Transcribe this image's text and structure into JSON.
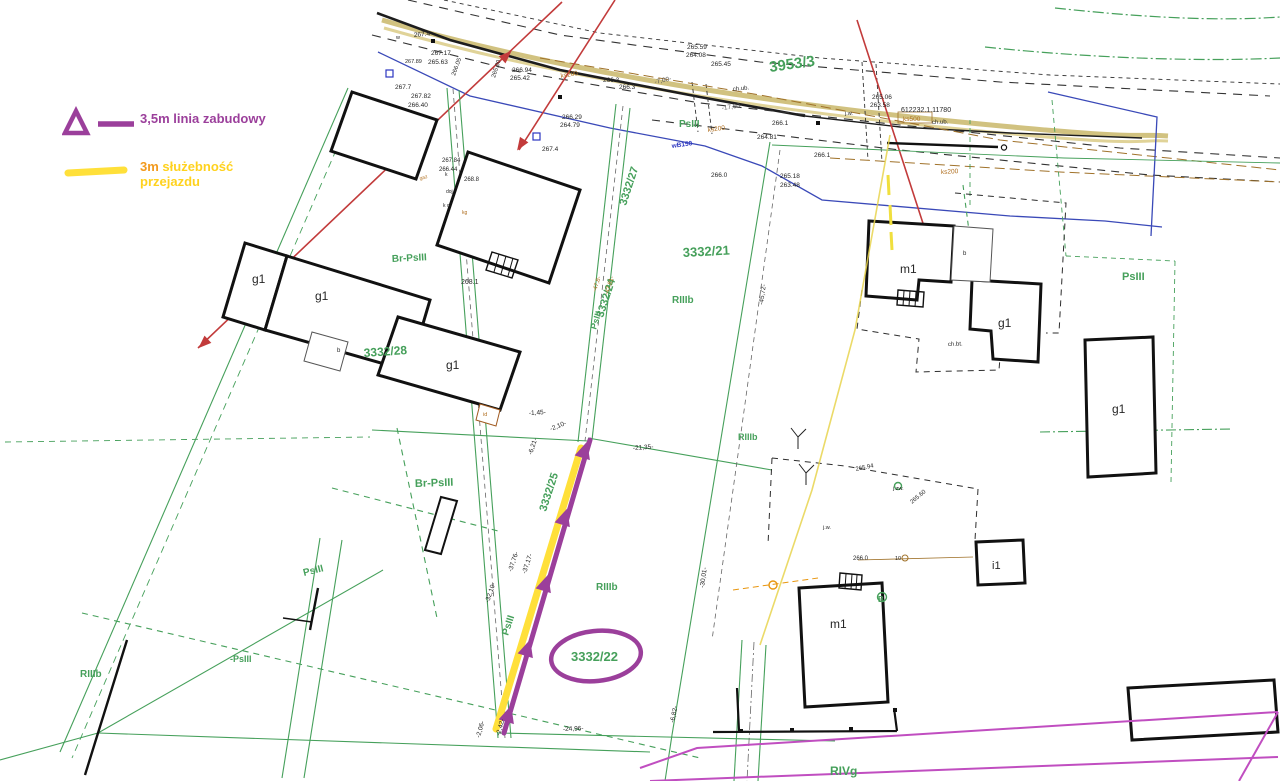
{
  "legend": {
    "line1": "3,5m linia zabudowy",
    "line2_prefix": "3m",
    "line2_word": "służebność",
    "line2_word2": "przejazdu"
  },
  "colors": {
    "building_line_purple": "#9b3f9b",
    "servitude_yellow": "#ffe03a",
    "legend_orange": "#f29a1e",
    "cadastral_green": "#46a05b",
    "power_red": "#c23b3b",
    "water_blue": "#3a49b8",
    "utility_brown": "#b06f20",
    "boundary_magenta": "#c04ec0",
    "road_khaki": "#c9b76a"
  },
  "map": {
    "labels": [
      {
        "t": "3953/3",
        "x": 770,
        "y": 72,
        "r": -8,
        "c": "green",
        "s": 15
      },
      {
        "t": "3332/21",
        "x": 683,
        "y": 257,
        "r": -3,
        "c": "green",
        "s": 13
      },
      {
        "t": "3332/22",
        "x": 571,
        "y": 661,
        "r": 0,
        "c": "green",
        "s": 13
      },
      {
        "t": "3332/28",
        "x": 364,
        "y": 357,
        "r": -4,
        "c": "green",
        "s": 12
      },
      {
        "t": "3332/27",
        "x": 626,
        "y": 206,
        "r": -72,
        "c": "green",
        "s": 11
      },
      {
        "t": "3332/24",
        "x": 603,
        "y": 318,
        "r": -72,
        "c": "green",
        "s": 11
      },
      {
        "t": "3332/25",
        "x": 546,
        "y": 512,
        "r": -72,
        "c": "green",
        "s": 11
      },
      {
        "t": "RIIIb",
        "x": 672,
        "y": 303,
        "r": 0,
        "c": "green",
        "s": 10
      },
      {
        "t": "RIIIb",
        "x": 596,
        "y": 590,
        "r": 0,
        "c": "green",
        "s": 10
      },
      {
        "t": "RIIIb",
        "x": 738,
        "y": 440,
        "r": 0,
        "c": "green",
        "s": 9
      },
      {
        "t": "RIIIb",
        "x": 80,
        "y": 677,
        "r": 0,
        "c": "green",
        "s": 10
      },
      {
        "t": "RIVg",
        "x": 830,
        "y": 775,
        "r": 0,
        "c": "green",
        "s": 12
      },
      {
        "t": "PsIII",
        "x": 1122,
        "y": 280,
        "r": 0,
        "c": "green",
        "s": 11
      },
      {
        "t": "PsIII",
        "x": 679,
        "y": 127,
        "r": 0,
        "c": "green",
        "s": 10
      },
      {
        "t": "PsIII",
        "x": 304,
        "y": 576,
        "r": -14,
        "c": "green",
        "s": 10
      },
      {
        "t": "-PsIII",
        "x": 230,
        "y": 662,
        "r": 0,
        "c": "green",
        "s": 9
      },
      {
        "t": "PsIII",
        "x": 596,
        "y": 330,
        "r": -72,
        "c": "green",
        "s": 9
      },
      {
        "t": "PsIII",
        "x": 508,
        "y": 636,
        "r": -72,
        "c": "green",
        "s": 10
      },
      {
        "t": "Br-PsIII",
        "x": 392,
        "y": 262,
        "r": -3,
        "c": "green",
        "s": 10
      },
      {
        "t": "Br-PsIII",
        "x": 415,
        "y": 487,
        "r": -2,
        "c": "green",
        "s": 11
      },
      {
        "t": "B",
        "x": 878,
        "y": 602,
        "r": 0,
        "c": "green",
        "s": 8
      },
      {
        "t": "g1",
        "x": 252,
        "y": 283,
        "r": 0,
        "c": "black",
        "s": 12
      },
      {
        "t": "g1",
        "x": 315,
        "y": 300,
        "r": 0,
        "c": "black",
        "s": 12
      },
      {
        "t": "g1",
        "x": 446,
        "y": 369,
        "r": 0,
        "c": "black",
        "s": 12
      },
      {
        "t": "g1",
        "x": 998,
        "y": 327,
        "r": 0,
        "c": "black",
        "s": 12
      },
      {
        "t": "g1",
        "x": 1112,
        "y": 413,
        "r": 0,
        "c": "black",
        "s": 12
      },
      {
        "t": "m1",
        "x": 900,
        "y": 273,
        "r": 0,
        "c": "black",
        "s": 12
      },
      {
        "t": "m1",
        "x": 830,
        "y": 628,
        "r": 0,
        "c": "black",
        "s": 12
      },
      {
        "t": "i1",
        "x": 992,
        "y": 569,
        "r": 0,
        "c": "black",
        "s": 11
      },
      {
        "t": "b",
        "x": 337,
        "y": 352,
        "r": 0,
        "c": "black",
        "s": 6
      },
      {
        "t": "b",
        "x": 963,
        "y": 255,
        "r": 0,
        "c": "black",
        "s": 6
      },
      {
        "t": "id",
        "x": 483,
        "y": 416,
        "r": 0,
        "c": "brown",
        "s": 5.5
      },
      {
        "t": "10",
        "x": 895,
        "y": 560,
        "r": 0,
        "c": "black",
        "s": 5.5
      },
      {
        "t": "w",
        "x": 396,
        "y": 39,
        "r": 0,
        "c": "black",
        "s": 5.5
      },
      {
        "t": "ch.bt.",
        "x": 948,
        "y": 346,
        "r": -2,
        "c": "black",
        "s": 6
      },
      {
        "t": "268.1",
        "x": 461,
        "y": 284,
        "r": 0,
        "c": "black",
        "s": 7
      },
      {
        "t": "267.4",
        "x": 414,
        "y": 37,
        "r": -5,
        "c": "black",
        "s": 6.5
      },
      {
        "t": "267.17",
        "x": 431,
        "y": 55,
        "r": 0,
        "c": "black",
        "s": 6.5
      },
      {
        "t": "265.63",
        "x": 428,
        "y": 64,
        "r": 0,
        "c": "black",
        "s": 6.5
      },
      {
        "t": "267.89",
        "x": 405,
        "y": 63,
        "r": 0,
        "c": "black",
        "s": 5.5
      },
      {
        "t": "266.05",
        "x": 455,
        "y": 76,
        "r": -70,
        "c": "black",
        "s": 6
      },
      {
        "t": "267.7",
        "x": 395,
        "y": 89,
        "r": 0,
        "c": "black",
        "s": 6.5
      },
      {
        "t": "267.82",
        "x": 411,
        "y": 98,
        "r": 0,
        "c": "black",
        "s": 6.5
      },
      {
        "t": "266.40",
        "x": 408,
        "y": 107,
        "r": 0,
        "c": "black",
        "s": 6.5
      },
      {
        "t": "265.80",
        "x": 495,
        "y": 78,
        "r": -72,
        "c": "black",
        "s": 6
      },
      {
        "t": "266.94",
        "x": 512,
        "y": 72,
        "r": 0,
        "c": "black",
        "s": 6.5
      },
      {
        "t": "265.42",
        "x": 510,
        "y": 80,
        "r": 0,
        "c": "black",
        "s": 6.5
      },
      {
        "t": "266.29",
        "x": 562,
        "y": 119,
        "r": 0,
        "c": "black",
        "s": 6.5
      },
      {
        "t": "264.79",
        "x": 560,
        "y": 127,
        "r": 0,
        "c": "black",
        "s": 6.5
      },
      {
        "t": "267.4",
        "x": 542,
        "y": 151,
        "r": 0,
        "c": "black",
        "s": 6.5
      },
      {
        "t": "266.3",
        "x": 603,
        "y": 82,
        "r": 0,
        "c": "black",
        "s": 6.5
      },
      {
        "t": "266.3",
        "x": 619,
        "y": 89,
        "r": 0,
        "c": "black",
        "s": 6.5
      },
      {
        "t": "265.59",
        "x": 687,
        "y": 49,
        "r": 0,
        "c": "black",
        "s": 6.5
      },
      {
        "t": "264.08",
        "x": 686,
        "y": 57,
        "r": 0,
        "c": "black",
        "s": 6.5
      },
      {
        "t": "265.45",
        "x": 711,
        "y": 66,
        "r": 0,
        "c": "black",
        "s": 6.5
      },
      {
        "t": "266.1",
        "x": 772,
        "y": 125,
        "r": 0,
        "c": "black",
        "s": 6.5
      },
      {
        "t": "264.81",
        "x": 757,
        "y": 139,
        "r": 0,
        "c": "black",
        "s": 6.5
      },
      {
        "t": "266.1",
        "x": 814,
        "y": 157,
        "r": 0,
        "c": "black",
        "s": 6.5
      },
      {
        "t": "265.06",
        "x": 872,
        "y": 99,
        "r": 0,
        "c": "black",
        "s": 6.5
      },
      {
        "t": "263.58",
        "x": 870,
        "y": 107,
        "r": 0,
        "c": "black",
        "s": 6.5
      },
      {
        "t": "612232.1.11780",
        "x": 901,
        "y": 112,
        "r": 0,
        "c": "black",
        "s": 7
      },
      {
        "t": "265.18",
        "x": 780,
        "y": 178,
        "r": 0,
        "c": "black",
        "s": 6.5
      },
      {
        "t": "263.48",
        "x": 780,
        "y": 187,
        "r": 0,
        "c": "black",
        "s": 6.5
      },
      {
        "t": "266.0",
        "x": 711,
        "y": 177,
        "r": 0,
        "c": "black",
        "s": 6.5
      },
      {
        "t": "266.0",
        "x": 853,
        "y": 560,
        "r": 0,
        "c": "black",
        "s": 6
      },
      {
        "t": "268.8",
        "x": 464,
        "y": 181,
        "r": 0,
        "c": "black",
        "s": 6
      },
      {
        "t": "267.84",
        "x": 442,
        "y": 162,
        "r": 0,
        "c": "black",
        "s": 6
      },
      {
        "t": "266.44",
        "x": 439,
        "y": 171,
        "r": 0,
        "c": "black",
        "s": 6
      },
      {
        "t": "265.94",
        "x": 856,
        "y": 471,
        "r": -12,
        "c": "black",
        "s": 6
      },
      {
        "t": "265.60",
        "x": 912,
        "y": 504,
        "r": -40,
        "c": "black",
        "s": 6
      },
      {
        "t": "k",
        "x": 445,
        "y": 176,
        "r": 0,
        "c": "black",
        "s": 5
      },
      {
        "t": "k o",
        "x": 443,
        "y": 207,
        "r": 0,
        "c": "black",
        "s": 5
      },
      {
        "t": "kg",
        "x": 462,
        "y": 214,
        "r": 0,
        "c": "brown",
        "s": 5
      },
      {
        "t": "gaz",
        "x": 420,
        "y": 180,
        "r": -15,
        "c": "brown",
        "s": 5
      },
      {
        "t": "doj.",
        "x": 446,
        "y": 193,
        "r": 0,
        "c": "black",
        "s": 5
      },
      {
        "t": "j.w.",
        "x": 823,
        "y": 529,
        "r": 0,
        "c": "black",
        "s": 5.5
      },
      {
        "t": "j.zw.",
        "x": 893,
        "y": 490,
        "r": 0,
        "c": "black",
        "s": 5.5
      },
      {
        "t": "j.w.",
        "x": 845,
        "y": 115,
        "r": 0,
        "c": "black",
        "s": 5.5
      },
      {
        "t": "-7,00-",
        "x": 655,
        "y": 84,
        "r": -12,
        "c": "gray",
        "s": 6.5
      },
      {
        "t": "-17,60-",
        "x": 722,
        "y": 110,
        "r": -8,
        "c": "gray",
        "s": 6.5
      },
      {
        "t": "-21,35-",
        "x": 633,
        "y": 450,
        "r": -4,
        "c": "black",
        "s": 6.5
      },
      {
        "t": "-2,10-",
        "x": 551,
        "y": 431,
        "r": -22,
        "c": "black",
        "s": 6.5
      },
      {
        "t": "-6,21-",
        "x": 532,
        "y": 455,
        "r": -72,
        "c": "black",
        "s": 6.5
      },
      {
        "t": "-37,76-",
        "x": 512,
        "y": 572,
        "r": -72,
        "c": "black",
        "s": 6.5
      },
      {
        "t": "-37,17-",
        "x": 526,
        "y": 574,
        "r": -72,
        "c": "black",
        "s": 6.5
      },
      {
        "t": "-32,10-",
        "x": 489,
        "y": 603,
        "r": -72,
        "c": "black",
        "s": 6.5
      },
      {
        "t": "-45,72-",
        "x": 763,
        "y": 305,
        "r": -82,
        "c": "black",
        "s": 6.5
      },
      {
        "t": "-30,01-",
        "x": 704,
        "y": 588,
        "r": -82,
        "c": "black",
        "s": 6.5
      },
      {
        "t": "-6,82-",
        "x": 674,
        "y": 723,
        "r": -78,
        "c": "black",
        "s": 6.5
      },
      {
        "t": "-24,96-",
        "x": 563,
        "y": 731,
        "r": -2,
        "c": "black",
        "s": 6.5
      },
      {
        "t": "-2,06-",
        "x": 480,
        "y": 738,
        "r": -75,
        "c": "black",
        "s": 6.5
      },
      {
        "t": "-2,42-",
        "x": 500,
        "y": 736,
        "r": -75,
        "c": "black",
        "s": 6.5
      },
      {
        "t": "-1,45-",
        "x": 529,
        "y": 415,
        "r": -3,
        "c": "black",
        "s": 6.5
      },
      {
        "t": "-47,8-",
        "x": 596,
        "y": 292,
        "r": -72,
        "c": "brown",
        "s": 6
      },
      {
        "t": "-47,81-",
        "x": 608,
        "y": 295,
        "r": -72,
        "c": "brown",
        "s": 6
      },
      {
        "t": "ks200",
        "x": 561,
        "y": 78,
        "r": -10,
        "c": "brown",
        "s": 6.5
      },
      {
        "t": "ks200",
        "x": 708,
        "y": 132,
        "r": -8,
        "c": "brown",
        "s": 6.5
      },
      {
        "t": "ks200",
        "x": 941,
        "y": 174,
        "r": -3,
        "c": "brown",
        "s": 6.5
      },
      {
        "t": "ks500",
        "x": 903,
        "y": 121,
        "r": 0,
        "c": "brown",
        "s": 6.5
      },
      {
        "t": "ch.ub.",
        "x": 733,
        "y": 91,
        "r": -6,
        "c": "black",
        "s": 6
      },
      {
        "t": "ch.ub.",
        "x": 932,
        "y": 124,
        "r": -2,
        "c": "black",
        "s": 6
      },
      {
        "t": "wB150",
        "x": 672,
        "y": 148,
        "r": -8,
        "c": "blue",
        "s": 6.5
      }
    ]
  }
}
